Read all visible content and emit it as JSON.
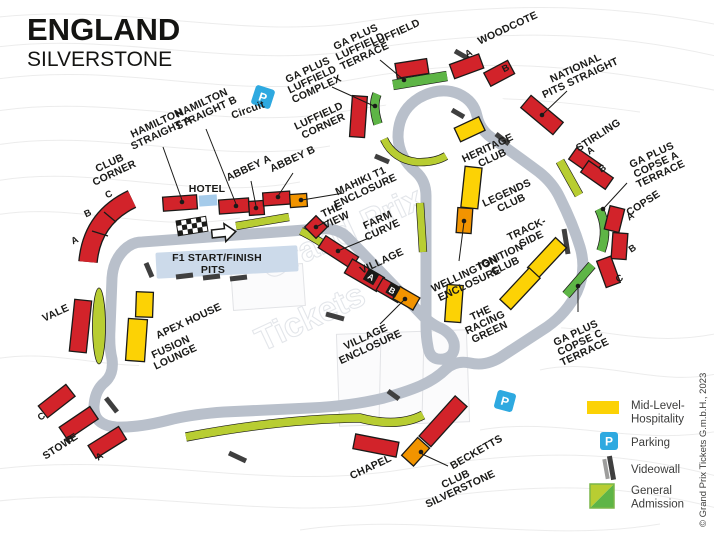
{
  "header": {
    "title": "ENGLAND",
    "subtitle": "SILVERSTONE"
  },
  "copyright": "© Grand Prix Tickets G.m.b.H., 2023",
  "watermark": {
    "line1": "Grand Prix",
    "line2": "Tickets"
  },
  "start_finish": {
    "line1": "F1 START/FINISH",
    "line2": "PITS"
  },
  "hotel_label": "HOTEL",
  "circuit_parking_label": "Circuit",
  "parking_letter": "P",
  "seat_letters": {
    "a": "A",
    "b": "B",
    "c": "C"
  },
  "labels": {
    "club_corner": {
      "l1": "CLUB",
      "l2": "CORNER"
    },
    "hamilton_a": {
      "l1": "HAMILTON",
      "l2": "STRAIGHT A"
    },
    "hamilton_b": {
      "l1": "HAMILTON",
      "l2": "STRAIGHT B"
    },
    "abbey_a": "ABBEY A",
    "abbey_b": "ABBEY B",
    "mahiki": {
      "l1": "MAHIKI T1",
      "l2": "ENCLOSURE"
    },
    "ga_luffield_complex": {
      "l1": "GA PLUS",
      "l2": "LUFFIELD",
      "l3": "COMPLEX"
    },
    "ga_luffield_terrace": {
      "l1": "GA PLUS",
      "l2": "LUFFIELD",
      "l3": "TERRACE"
    },
    "luffield_corner": {
      "l1": "LUFFIELD",
      "l2": "CORNER"
    },
    "luffield": "LUFFIELD",
    "woodcote": "WOODCOTE",
    "national_pits": {
      "l1": "NATIONAL",
      "l2": "PITS STRAIGHT"
    },
    "stirling": "STIRLING",
    "ga_copse_a": {
      "l1": "GA PLUS",
      "l2": "COPSE A",
      "l3": "TERRACE"
    },
    "copse": "COPSE",
    "ga_copse_c": {
      "l1": "GA PLUS",
      "l2": "COPSE C",
      "l3": "TERRACE"
    },
    "heritage": {
      "l1": "HERITAGE",
      "l2": "CLUB"
    },
    "legends": {
      "l1": "LEGENDS",
      "l2": "CLUB"
    },
    "trackside": {
      "l1": "TRACK-",
      "l2": "SIDE"
    },
    "ignition": {
      "l1": "IGNITION",
      "l2": "CLUB"
    },
    "wellington": {
      "l1": "WELLINGTON",
      "l2": "ENCLOSURE"
    },
    "the_view": {
      "l1": "THE",
      "l2": "VIEW"
    },
    "farm_curve": {
      "l1": "FARM",
      "l2": "CURVE"
    },
    "village": "VILLAGE",
    "village_enclosure": {
      "l1": "VILLAGE",
      "l2": "ENCLOSURE"
    },
    "racing_green": {
      "l1": "THE",
      "l2": "RACING",
      "l3": "GREEN"
    },
    "apex_house": "APEX HOUSE",
    "fusion_lounge": {
      "l1": "FUSION",
      "l2": "LOUNGE"
    },
    "vale": "VALE",
    "stowe": "STOWE",
    "chapel": "CHAPEL",
    "becketts": "BECKETTS",
    "club_silverstone": {
      "l1": "CLUB",
      "l2": "SILVERSTONE"
    }
  },
  "legend": {
    "hospitality": {
      "l1": "Mid-Level-",
      "l2": "Hospitality"
    },
    "parking": "Parking",
    "videowall": "Videowall",
    "general_admission": {
      "l1": "General",
      "l2": "Admission"
    }
  },
  "colors": {
    "grandstand_red": "#d2232a",
    "hospitality_yellow": "#fcd205",
    "enclosure_orange": "#f29400",
    "ga_green": "#5eb546",
    "ga_yellow_green": "#b8cd32",
    "track_gray": "#b9c0cb",
    "parking_blue": "#2ea9e0",
    "videowall_gray": "#3f3f3f"
  }
}
